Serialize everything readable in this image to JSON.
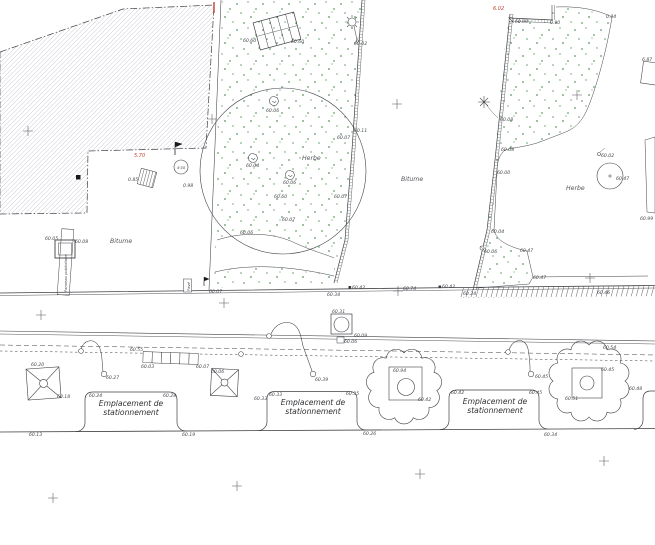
{
  "plan": {
    "type": "cad-site-plan",
    "colors": {
      "line": "#3f4045",
      "hatch": "#b7b7bf",
      "green_dot": "#5f9c63",
      "red_accent": "#c04330",
      "label": "#45474c",
      "background": "#ffffff"
    },
    "labels": [
      {
        "t": "60.60",
        "x": 243,
        "y": 42
      },
      {
        "t": "60.60",
        "x": 291,
        "y": 43
      },
      {
        "t": "60.02",
        "x": 354,
        "y": 45
      },
      {
        "t": "60.06",
        "x": 266,
        "y": 112
      },
      {
        "t": "60.04",
        "x": 246,
        "y": 167
      },
      {
        "t": "60.06",
        "x": 283,
        "y": 184
      },
      {
        "t": "60.60",
        "x": 274,
        "y": 198
      },
      {
        "t": "60.07",
        "x": 282,
        "y": 221
      },
      {
        "t": "60.06",
        "x": 240,
        "y": 234
      },
      {
        "t": "60.07",
        "x": 337,
        "y": 139
      },
      {
        "t": "60.11",
        "x": 354,
        "y": 132
      },
      {
        "t": "60.07",
        "x": 334,
        "y": 198
      },
      {
        "t": "0.85",
        "x": 128,
        "y": 181
      },
      {
        "t": "0.98",
        "x": 183,
        "y": 187
      },
      {
        "t": "60.05",
        "x": 45,
        "y": 240
      },
      {
        "t": "60.08",
        "x": 75,
        "y": 243
      },
      {
        "t": "60.07",
        "x": 209,
        "y": 293
      },
      {
        "t": "60.34",
        "x": 327,
        "y": 296
      },
      {
        "t": "60.42",
        "x": 352,
        "y": 289
      },
      {
        "t": "60.74",
        "x": 403,
        "y": 290
      },
      {
        "t": "60.42",
        "x": 442,
        "y": 288
      },
      {
        "t": "60.34",
        "x": 463,
        "y": 295
      },
      {
        "t": "60.46",
        "x": 597,
        "y": 294
      },
      {
        "t": "6.02",
        "x": 493,
        "y": 10,
        "k": "r",
        "n": "dimension-label"
      },
      {
        "t": "5.70",
        "x": 134,
        "y": 157,
        "k": "r",
        "n": "dimension-label"
      },
      {
        "t": "60.00",
        "x": 515,
        "y": 23
      },
      {
        "t": "0.90",
        "x": 550,
        "y": 24
      },
      {
        "t": "0.94",
        "x": 606,
        "y": 18
      },
      {
        "t": "6.87",
        "x": 642,
        "y": 61
      },
      {
        "t": "60.99",
        "x": 640,
        "y": 220
      },
      {
        "t": "60.08",
        "x": 500,
        "y": 121
      },
      {
        "t": "60.08",
        "x": 501,
        "y": 151
      },
      {
        "t": "60.00",
        "x": 497,
        "y": 174
      },
      {
        "t": "60.02",
        "x": 601,
        "y": 157
      },
      {
        "t": "60.47",
        "x": 616,
        "y": 180
      },
      {
        "t": "60.04",
        "x": 491,
        "y": 233
      },
      {
        "t": "60.06",
        "x": 484,
        "y": 253
      },
      {
        "t": "60.47",
        "x": 520,
        "y": 252
      },
      {
        "t": "60.47",
        "x": 533,
        "y": 279
      },
      {
        "t": "60.55",
        "x": 130,
        "y": 351
      },
      {
        "t": "60.03",
        "x": 141,
        "y": 368
      },
      {
        "t": "60.07",
        "x": 196,
        "y": 368
      },
      {
        "t": "60.27",
        "x": 106,
        "y": 379
      },
      {
        "t": "60.20",
        "x": 31,
        "y": 366
      },
      {
        "t": "60.18",
        "x": 57,
        "y": 398
      },
      {
        "t": "60.06",
        "x": 211,
        "y": 373
      },
      {
        "t": "60.33",
        "x": 254,
        "y": 400
      },
      {
        "t": "60.31",
        "x": 332,
        "y": 313
      },
      {
        "t": "60.09",
        "x": 354,
        "y": 337
      },
      {
        "t": "60.06",
        "x": 344,
        "y": 343
      },
      {
        "t": "60.39",
        "x": 315,
        "y": 381
      },
      {
        "t": "60.45",
        "x": 535,
        "y": 378
      },
      {
        "t": "60.54",
        "x": 603,
        "y": 349
      },
      {
        "t": "60.94",
        "x": 393,
        "y": 372
      },
      {
        "t": "60.42",
        "x": 418,
        "y": 401
      },
      {
        "t": "60.45",
        "x": 601,
        "y": 371
      },
      {
        "t": "60.51",
        "x": 565,
        "y": 400
      },
      {
        "t": "60.48",
        "x": 629,
        "y": 390
      },
      {
        "t": "60.24",
        "x": 89,
        "y": 397
      },
      {
        "t": "60.28",
        "x": 163,
        "y": 397
      },
      {
        "t": "60.33",
        "x": 269,
        "y": 396
      },
      {
        "t": "60.35",
        "x": 346,
        "y": 395
      },
      {
        "t": "60.42",
        "x": 451,
        "y": 394
      },
      {
        "t": "60.45",
        "x": 529,
        "y": 394
      },
      {
        "t": "60.13",
        "x": 29,
        "y": 436
      },
      {
        "t": "60.19",
        "x": 182,
        "y": 436
      },
      {
        "t": "60.26",
        "x": 363,
        "y": 435
      },
      {
        "t": "60.34",
        "x": 544,
        "y": 436
      },
      {
        "t": "Herbe",
        "x": 302,
        "y": 160,
        "k": "a",
        "n": "surface-label-herbe"
      },
      {
        "t": "Herbe",
        "x": 566,
        "y": 190,
        "k": "a",
        "n": "surface-label-herbe"
      },
      {
        "t": "Bitume",
        "x": 110,
        "y": 243,
        "k": "a",
        "n": "surface-label-bitume"
      },
      {
        "t": "Bitume",
        "x": 401,
        "y": 181,
        "k": "a",
        "n": "surface-label-bitume"
      },
      {
        "t": "Emplacement de",
        "x": 131,
        "y": 406,
        "k": "p",
        "n": "parking-bay-label"
      },
      {
        "t": "stationnement",
        "x": 131,
        "y": 415,
        "k": "p",
        "n": "parking-bay-label"
      },
      {
        "t": "Emplacement de",
        "x": 313,
        "y": 405,
        "k": "p",
        "n": "parking-bay-label"
      },
      {
        "t": "stationnement",
        "x": 313,
        "y": 414,
        "k": "p",
        "n": "parking-bay-label"
      },
      {
        "t": "Emplacement de",
        "x": 495,
        "y": 404,
        "k": "p",
        "n": "parking-bay-label"
      },
      {
        "t": "stationnement",
        "x": 495,
        "y": 413,
        "k": "p",
        "n": "parking-bay-label"
      },
      {
        "t": "Panneau publicitaire",
        "x": 67,
        "y": 292,
        "k": "v",
        "rot": -90,
        "n": "billboard-text"
      },
      {
        "t": "Pavé",
        "x": 190,
        "y": 291,
        "k": "v",
        "rot": -90,
        "n": "pave-text"
      },
      {
        "t": "4'50",
        "x": 181,
        "y": 169,
        "k": "c",
        "n": "tree-note"
      }
    ],
    "grid_crosses": [
      [
        28,
        131
      ],
      [
        212,
        119
      ],
      [
        397,
        104
      ],
      [
        577,
        95
      ],
      [
        41,
        315
      ],
      [
        224,
        303
      ],
      [
        398,
        291
      ],
      [
        590,
        278
      ],
      [
        53,
        498
      ],
      [
        237,
        486
      ],
      [
        420,
        474
      ],
      [
        604,
        461
      ]
    ],
    "bushes": [
      [
        274,
        101
      ],
      [
        253,
        158
      ],
      [
        290,
        175
      ]
    ]
  }
}
